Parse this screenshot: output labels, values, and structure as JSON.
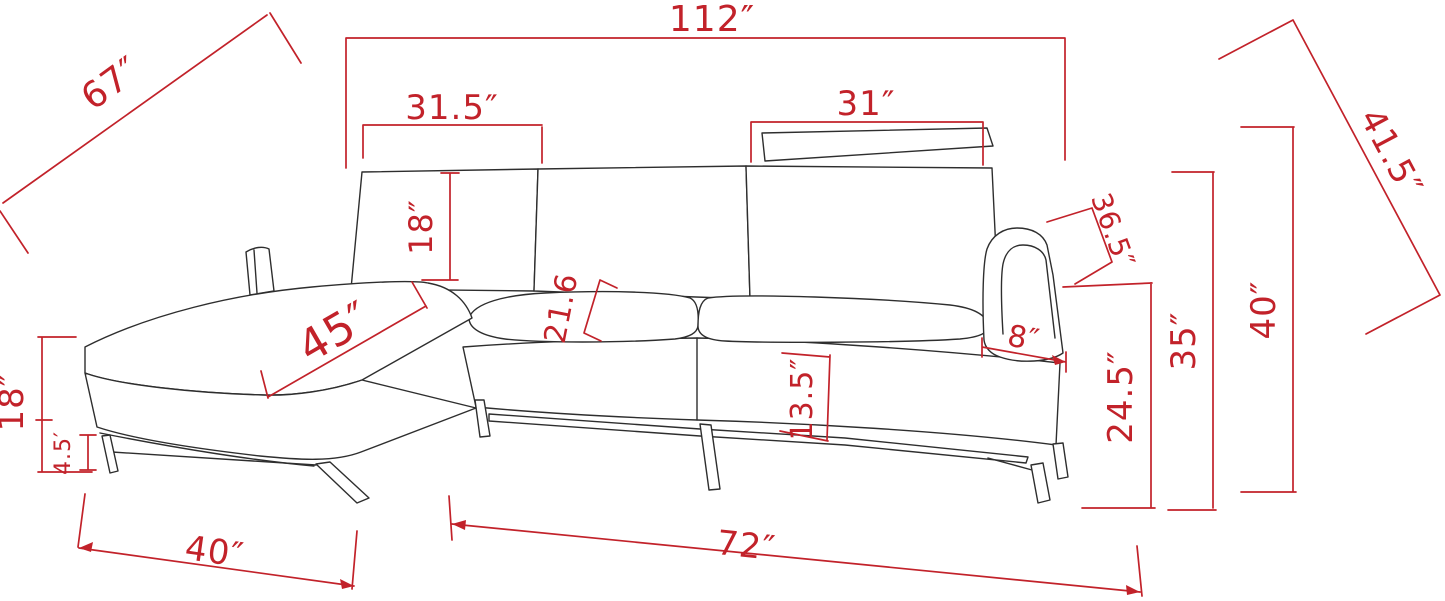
{
  "diagram": {
    "type": "furniture-dimension-drawing",
    "subject": "sectional sofa with left chaise, headrest and metal legs",
    "colors": {
      "dimension_red": "#c2222a",
      "outline_black": "#2e2e2e",
      "background": "#ffffff"
    },
    "dimensions": {
      "overall_width": {
        "label": "112″",
        "inches": 112
      },
      "chaise_diagonal": {
        "label": "67″",
        "inches": 67
      },
      "chaise_back_width": {
        "label": "31.5″",
        "inches": 31.5
      },
      "headrest_width": {
        "label": "31″",
        "inches": 31
      },
      "back_diagonal": {
        "label": "41.5″",
        "inches": 41.5
      },
      "chaise_back_height": {
        "label": "18″",
        "inches": 18
      },
      "chaise_seat_diagonal": {
        "label": "45″",
        "inches": 45
      },
      "seat_depth": {
        "label": "21.6",
        "inches": 21.6
      },
      "arm_diagonal": {
        "label": "36.5″",
        "inches": 36.5
      },
      "arm_width": {
        "label": "8″",
        "inches": 8
      },
      "seat_front_height": {
        "label": "13.5″",
        "inches": 13.5
      },
      "arm_height": {
        "label": "24.5″",
        "inches": 24.5
      },
      "back_height": {
        "label": "35″",
        "inches": 35
      },
      "overall_height": {
        "label": "40″",
        "inches": 40
      },
      "seat_height": {
        "label": "18″",
        "inches": 18
      },
      "leg_height": {
        "label": "4.5′",
        "inches": 4.5
      },
      "chaise_width": {
        "label": "40″",
        "inches": 40
      },
      "front_length": {
        "label": "72″",
        "inches": 72
      }
    }
  }
}
